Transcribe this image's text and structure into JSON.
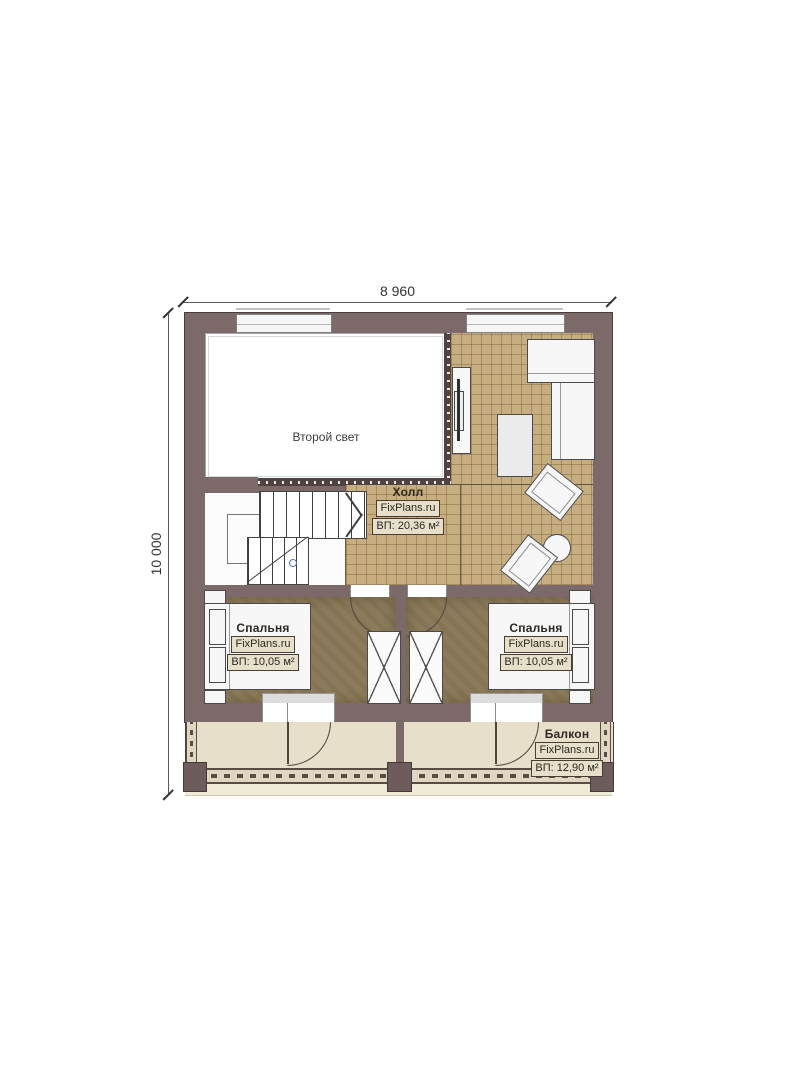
{
  "dimensions": {
    "top": "8 960",
    "left": "10 000"
  },
  "rooms": {
    "second_light": {
      "name": "Второй свет"
    },
    "hall": {
      "name": "Холл",
      "brand": "FixPlans.ru",
      "area": "ВП: 20,36 м²"
    },
    "bedroom_left": {
      "name": "Спальня",
      "brand": "FixPlans.ru",
      "area": "ВП: 10,05 м²"
    },
    "bedroom_right": {
      "name": "Спальня",
      "brand": "FixPlans.ru",
      "area": "ВП: 10,05 м²"
    },
    "balcony": {
      "name": "Балкон",
      "brand": "FixPlans.ru",
      "area": "ВП: 12,90 м²"
    }
  },
  "colors": {
    "wall": "#7c6a6a",
    "wall_edge": "#4a3d3d",
    "hall_tile": "#c6ae80",
    "bedroom_floor": "#8c7b5b",
    "balcony_floor": "#e8dfca",
    "label_box_bg": "#e6dfca",
    "label_border": "#4a3e33",
    "dimension_line": "#5a5a5a"
  }
}
